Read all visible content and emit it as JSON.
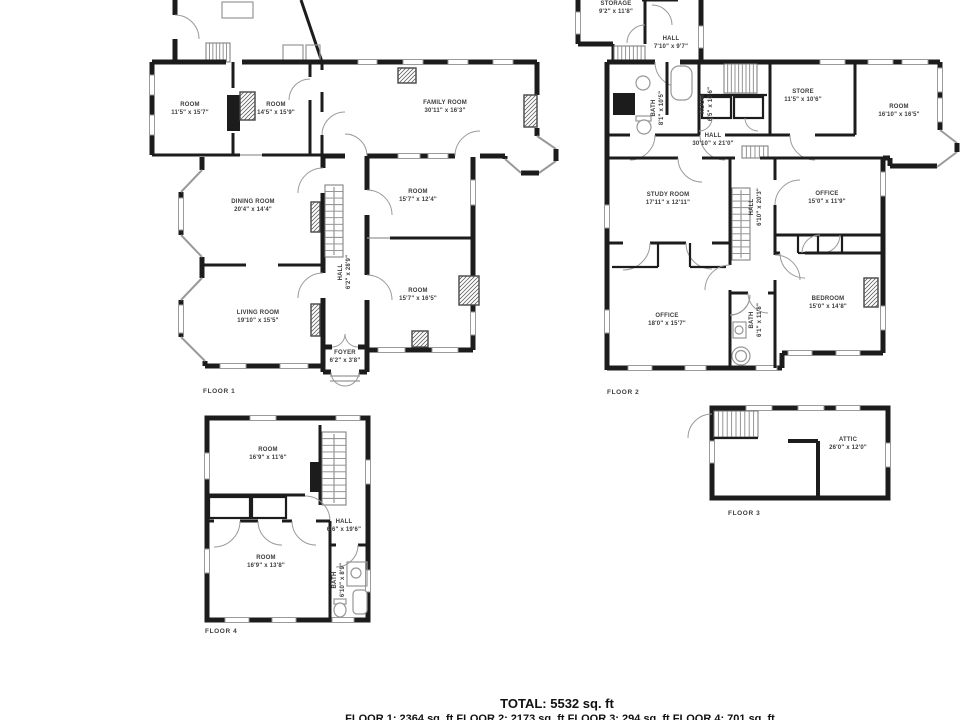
{
  "colors": {
    "wall": "#1c1c1c",
    "fixture": "#979797",
    "label_text": "#3c3c3c",
    "background": "#ffffff"
  },
  "floors": [
    {
      "caption": "FLOOR 1",
      "caption_pos": {
        "x": 203,
        "y": 388
      },
      "rooms": [
        {
          "name": "ROOM",
          "dims": "11'5\" x 15'7\"",
          "x": 190,
          "y": 110,
          "rot": false
        },
        {
          "name": "ROOM",
          "dims": "14'5\" x 15'9\"",
          "x": 276,
          "y": 110,
          "rot": false
        },
        {
          "name": "FAMILY ROOM",
          "dims": "30'11\" x 16'3\"",
          "x": 445,
          "y": 108,
          "rot": false
        },
        {
          "name": "DINING ROOM",
          "dims": "20'4\" x 14'4\"",
          "x": 253,
          "y": 207,
          "rot": false
        },
        {
          "name": "ROOM",
          "dims": "15'7\" x 12'4\"",
          "x": 418,
          "y": 197,
          "rot": false
        },
        {
          "name": "HALL",
          "dims": "6'2\" x 28'9\"",
          "x": 346,
          "y": 272,
          "rot": true
        },
        {
          "name": "LIVING ROOM",
          "dims": "19'10\" x 15'5\"",
          "x": 258,
          "y": 318,
          "rot": false
        },
        {
          "name": "ROOM",
          "dims": "15'7\" x 16'5\"",
          "x": 418,
          "y": 296,
          "rot": false
        },
        {
          "name": "FOYER",
          "dims": "6'2\" x 3'8\"",
          "x": 345,
          "y": 358,
          "rot": false
        }
      ]
    },
    {
      "caption": "FLOOR 2",
      "caption_pos": {
        "x": 607,
        "y": 389
      },
      "rooms": [
        {
          "name": "STORAGE",
          "dims": "9'2\" x 11'8\"",
          "x": 616,
          "y": 9,
          "rot": false
        },
        {
          "name": "HALL",
          "dims": "7'10\" x 9'7\"",
          "x": 671,
          "y": 44,
          "rot": false
        },
        {
          "name": "BATH",
          "dims": "8'1\" x 10'5\"",
          "x": 659,
          "y": 108,
          "rot": true
        },
        {
          "name": "ROOM",
          "dims": "6'5\" x 10'6\"",
          "x": 708,
          "y": 104,
          "rot": true
        },
        {
          "name": "STORE",
          "dims": "11'5\" x 10'6\"",
          "x": 803,
          "y": 97,
          "rot": false
        },
        {
          "name": "ROOM",
          "dims": "16'10\" x 16'5\"",
          "x": 899,
          "y": 112,
          "rot": false
        },
        {
          "name": "HALL",
          "dims": "30'10\" x 21'0\"",
          "x": 713,
          "y": 141,
          "rot": false
        },
        {
          "name": "STUDY ROOM",
          "dims": "17'11\" x 12'11\"",
          "x": 668,
          "y": 200,
          "rot": false
        },
        {
          "name": "HALL",
          "dims": "6'10\" x 20'3\"",
          "x": 757,
          "y": 207,
          "rot": true
        },
        {
          "name": "OFFICE",
          "dims": "15'0\" x 11'9\"",
          "x": 827,
          "y": 199,
          "rot": false
        },
        {
          "name": "OFFICE",
          "dims": "18'0\" x 15'7\"",
          "x": 667,
          "y": 321,
          "rot": false
        },
        {
          "name": "BATH",
          "dims": "6'1\" x 11'8\"",
          "x": 757,
          "y": 320,
          "rot": true
        },
        {
          "name": "BEDROOM",
          "dims": "15'0\" x 14'8\"",
          "x": 828,
          "y": 304,
          "rot": false
        }
      ]
    },
    {
      "caption": "FLOOR 3",
      "caption_pos": {
        "x": 728,
        "y": 510
      },
      "rooms": [
        {
          "name": "ATTIC",
          "dims": "26'0\" x 12'0\"",
          "x": 848,
          "y": 445,
          "rot": false
        }
      ]
    },
    {
      "caption": "FLOOR 4",
      "caption_pos": {
        "x": 205,
        "y": 628
      },
      "rooms": [
        {
          "name": "ROOM",
          "dims": "16'9\" x 11'6\"",
          "x": 268,
          "y": 455,
          "rot": false
        },
        {
          "name": "HALL",
          "dims": "6'6\" x 19'6\"",
          "x": 344,
          "y": 527,
          "rot": false
        },
        {
          "name": "ROOM",
          "dims": "16'9\" x 13'8\"",
          "x": 266,
          "y": 563,
          "rot": false
        },
        {
          "name": "BATH",
          "dims": "6'10\" x 8'9\"",
          "x": 340,
          "y": 580,
          "rot": true
        }
      ]
    }
  ],
  "footer": {
    "total": "TOTAL: 5532 sq. ft",
    "breakdown": "FLOOR 1: 2364 sq. ft  FLOOR 2: 2173 sq. ft  FLOOR 3: 294 sq. ft  FLOOR 4: 701 sq. ft"
  }
}
